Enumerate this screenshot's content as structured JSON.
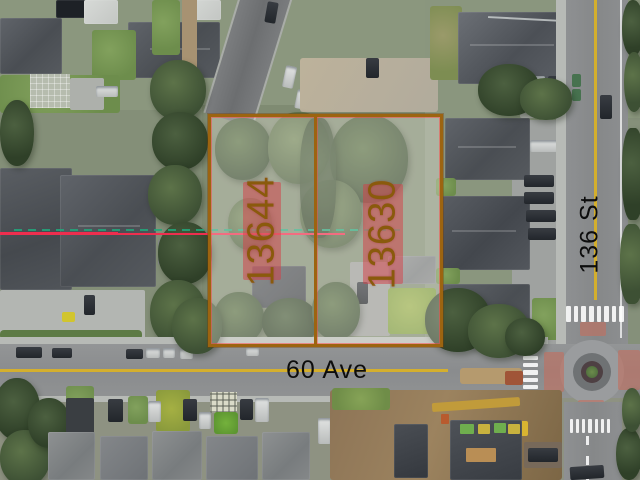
{
  "scene": {
    "type": "aerial-property-photo",
    "description": "Drone aerial view of two adjacent treed residential lots outlined for sale at the corner of 60 Ave and 136 St, with a roundabout intersection at lower right"
  },
  "lots": [
    {
      "label": "13644",
      "position": "west"
    },
    {
      "label": "13630",
      "position": "east"
    }
  ],
  "streets": [
    {
      "label": "60 Ave",
      "orientation": "horizontal"
    },
    {
      "label": "136 St",
      "orientation": "vertical"
    }
  ],
  "colors": {
    "lot_border": "#9c6410",
    "lot_fill": "rgba(255,252,245,0.30)",
    "lot_label_text": "#8a5a0c",
    "lot_label_highlight": "rgba(214,62,70,0.50)",
    "street_label_text": "#0d0d0d",
    "road_center_line": "#d4af2e",
    "measure_line_red": "#ee2e4e",
    "measure_line_green": "#21a87c"
  }
}
